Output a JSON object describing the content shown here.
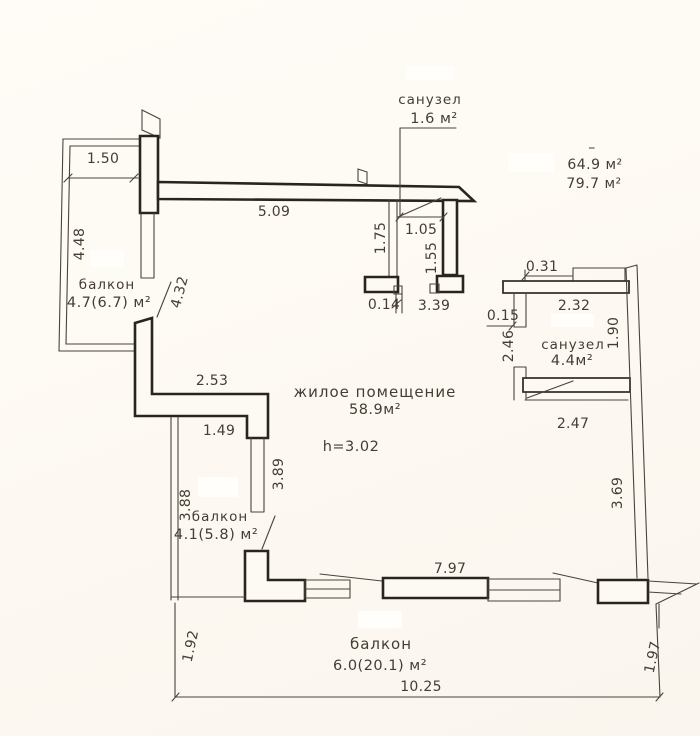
{
  "rooms": {
    "living": {
      "name": "жилое помещение",
      "area": "58.9м²",
      "ceiling_height": "h=3.02"
    },
    "wc_top": {
      "name": "санузел",
      "area": "1.6 м²"
    },
    "wc_right": {
      "name": "санузел",
      "area": "4.4м²"
    },
    "balcony_left": {
      "name": "балкон",
      "area": "4.7(6.7) м²"
    },
    "balcony_lower": {
      "name": "балкон",
      "area": "4.1(5.8) м²"
    },
    "balcony_bottom": {
      "name": "балкон",
      "area": "6.0(20.1) м²"
    }
  },
  "totals": {
    "mark": "–",
    "living_area": "64.9 м²",
    "total_area": "79.7 м²"
  },
  "dims": {
    "balcony_left_width": "1.50",
    "balcony_left_height": "4.48",
    "left_wall": "4.32",
    "top_wall": "5.09",
    "wc_top_left": "1.75",
    "wc_top_door": "1.05",
    "wc_top_right": "1.55",
    "wc_top_gap": "0.14",
    "top_opening": "3.39",
    "wc_right_notch": "0.31",
    "wc_right_width": "2.32",
    "wc_right_gap": "0.15",
    "wc_right_left_height": "2.46",
    "wc_right_height": "1.90",
    "wc_right_bottom": "2.47",
    "step_wall_width": "2.53",
    "living_door": "1.49",
    "balcony_lower_inner": "3.89",
    "balcony_lower_height": "3.88",
    "right_wall": "3.69",
    "bottom_window": "7.97",
    "balcony_bottom_left": "1.92",
    "balcony_bottom_right": "1.97",
    "balcony_bottom_width": "10.25"
  },
  "colors": {
    "background": "#fdf9f2",
    "line": "#29241f",
    "text": "#453d33"
  }
}
